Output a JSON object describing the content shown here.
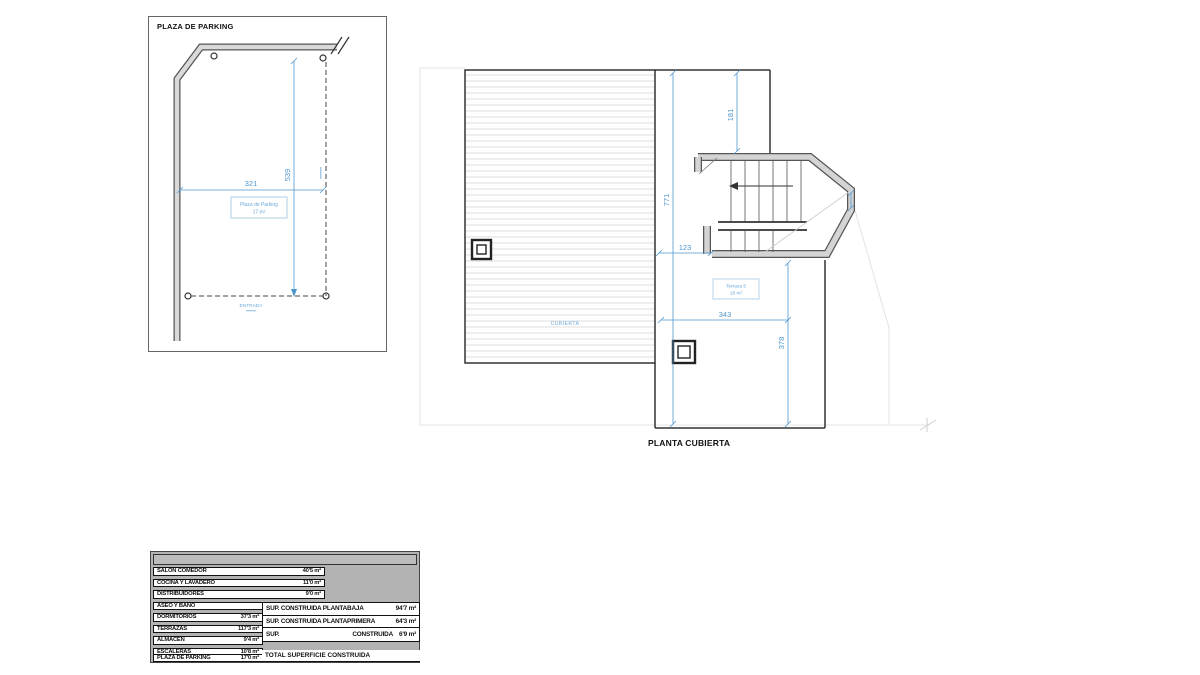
{
  "parking": {
    "title": "PLAZA DE PARKING",
    "width_dim": "321",
    "height_dim": "539",
    "space_label": "Plaza de Parking",
    "space_area": "17 m²",
    "entrance_label": "ENTRADA"
  },
  "roof_plan": {
    "title": "PLANTA CUBIERTA",
    "roof_label": "CUBIERTA",
    "terrace_label": "Terraza 5",
    "terrace_area": "18 m²",
    "dim_width_upper": "181",
    "dim_height_total": "771",
    "dim_width_small": "123",
    "dim_width_terrace": "343",
    "dim_height_terrace": "378"
  },
  "areas_table": {
    "rows": [
      {
        "label": "SALON COMEDOR",
        "value": "40'5 m²"
      },
      {
        "label": "COCINA Y LAVADERO",
        "value": "11'0 m²"
      },
      {
        "label": "DISTRIBUIDORES",
        "value": "9'0 m²"
      },
      {
        "label": "ASEO Y BAÑO",
        "value": "6'3 m²"
      },
      {
        "label": "DORMITORIOS",
        "value": "37'3 m²"
      },
      {
        "label": "TERRAZAS",
        "value": "117'3 m²"
      },
      {
        "label": "ALMACEN",
        "value": "9'4 m²"
      },
      {
        "label": "ESCALERAS",
        "value": "10'8 m²"
      },
      {
        "label": "PLAZA DE PARKING",
        "value": "17'0 m²"
      }
    ]
  },
  "summary_table": {
    "rows": [
      {
        "label": "SUP. CONSTRUIDA PLANTABAJA",
        "value": "94'7 m²"
      },
      {
        "label": "SUP. CONSTRUIDA PLANTAPRIMERA",
        "value": "64'3 m²"
      },
      {
        "label": "SUP.",
        "label2": "CONSTRUIDA",
        "value": "6'9 m²"
      }
    ],
    "total_label": "TOTAL SUPERFICIE CONSTRUIDA"
  },
  "colors": {
    "dimension_blue": "#4f97ce",
    "label_blue": "#7ab1d8",
    "wall_gray": "#d4d4d4",
    "table_gray": "#b3b3b3"
  }
}
